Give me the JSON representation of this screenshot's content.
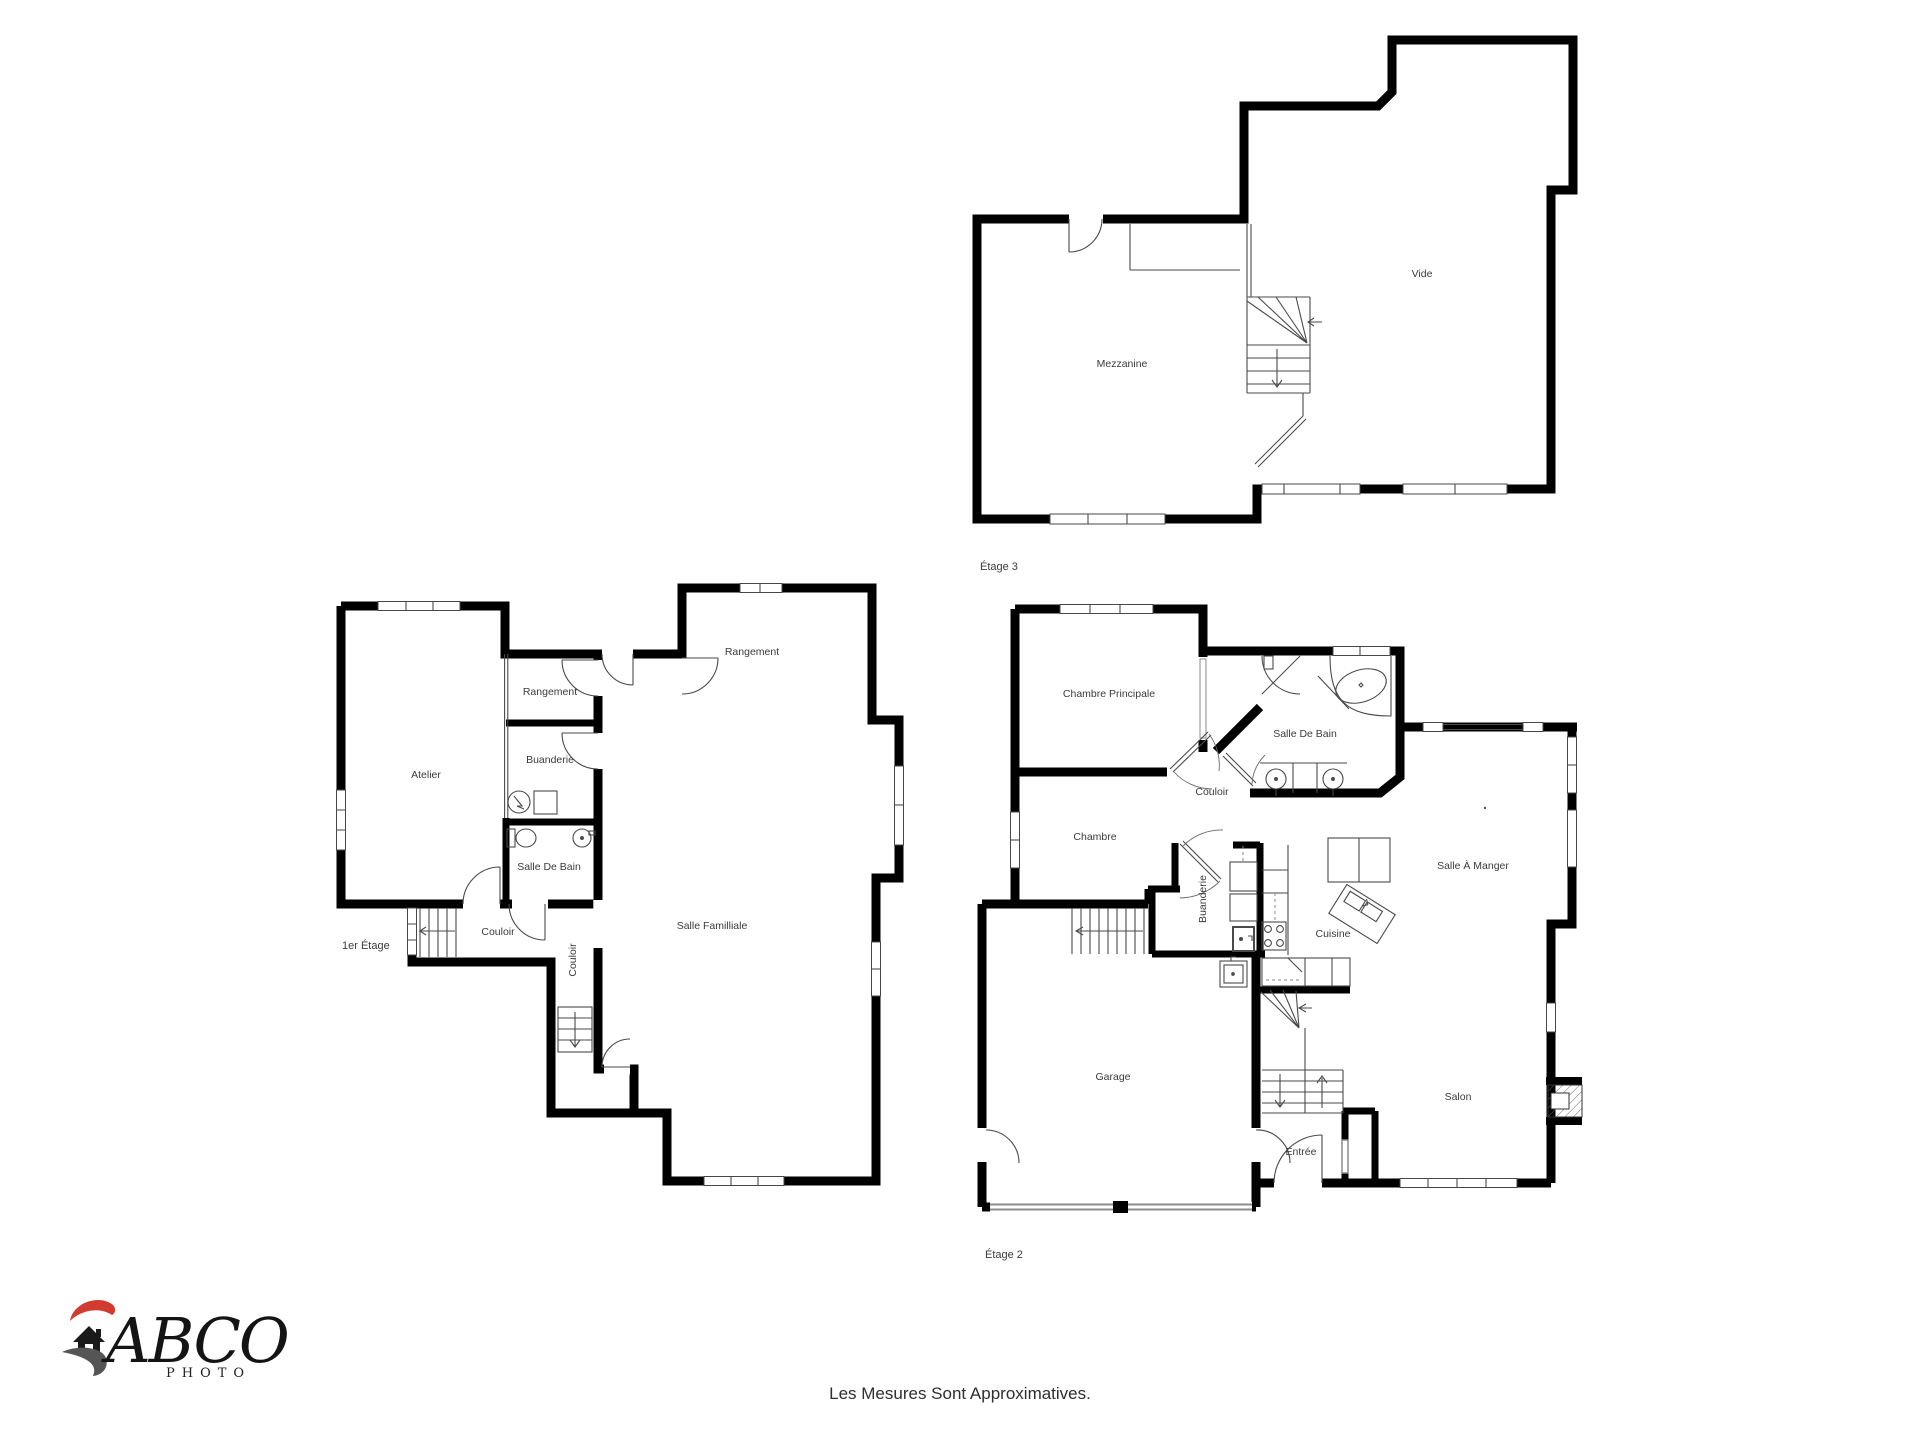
{
  "caption": "Les Mesures Sont Approximatives.",
  "logo": {
    "brand": "ABCO",
    "subtitle": "PHOTO"
  },
  "colors": {
    "wall": "#000000",
    "thin_line": "#4a4a4a",
    "label": "#3b3b3b",
    "logo_red": "#d23b2f",
    "logo_gray": "#555555"
  },
  "floors": [
    {
      "label": "Étage 3",
      "rooms": [
        {
          "name": "Mezzanine"
        },
        {
          "name": "Vide"
        }
      ]
    },
    {
      "label": "1er Étage",
      "rooms": [
        {
          "name": "Atelier"
        },
        {
          "name": "Rangement"
        },
        {
          "name": "Buanderie"
        },
        {
          "name": "Salle De Bain"
        },
        {
          "name": "Couloir"
        },
        {
          "name": "Couloir"
        },
        {
          "name": "Salle Familliale"
        },
        {
          "name": "Rangement"
        }
      ]
    },
    {
      "label": "Étage 2",
      "rooms": [
        {
          "name": "Chambre Principale"
        },
        {
          "name": "Salle De Bain"
        },
        {
          "name": "Couloir"
        },
        {
          "name": "Chambre"
        },
        {
          "name": "Buanderie"
        },
        {
          "name": "Cuisine"
        },
        {
          "name": "Salle À Manger"
        },
        {
          "name": "Garage"
        },
        {
          "name": "Entrée"
        },
        {
          "name": "Salon"
        }
      ]
    }
  ]
}
